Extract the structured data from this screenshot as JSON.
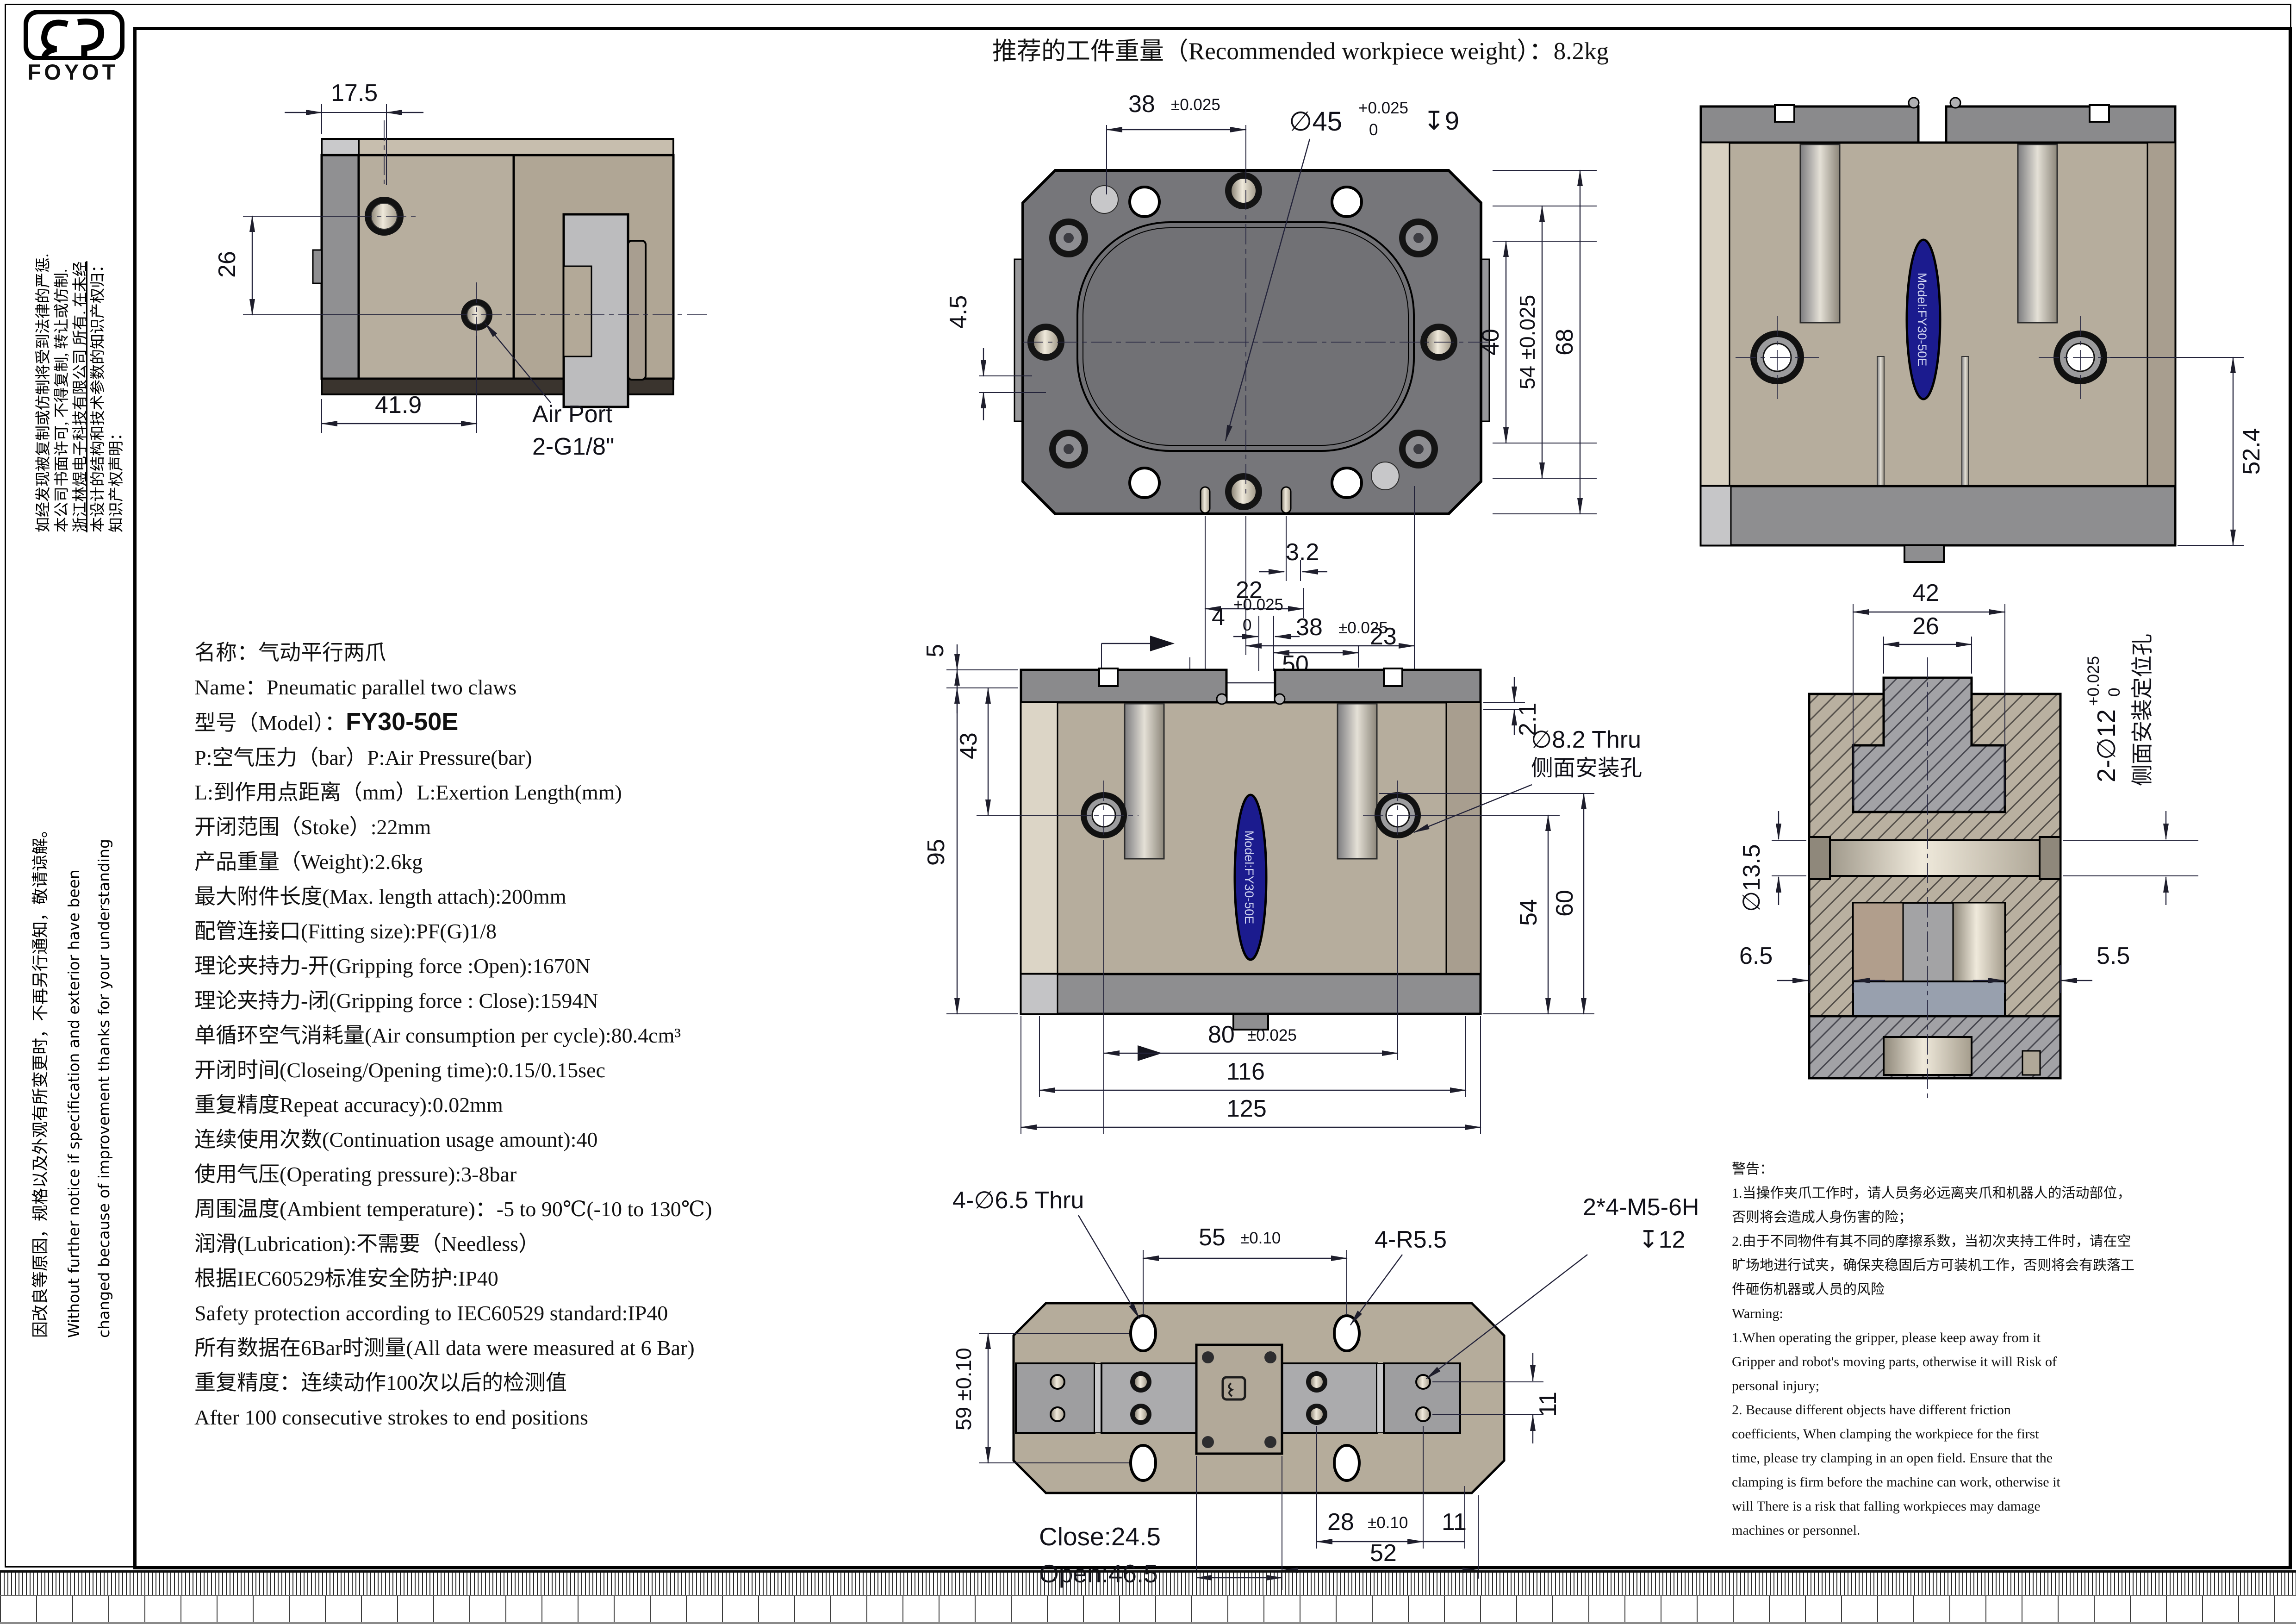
{
  "page": {
    "title": "推荐的工件重量（Recommended workpiece weight）：8.2kg"
  },
  "sidebar": {
    "brand": "FOYOT",
    "ip_lines": [
      "知识产权声明：",
      "本设计的结构和技术参数的知识产权归：",
      "浙江林煜电子科技有限公司 所有. 在未经",
      "本公司书面许可, 不得复制, 转让或仿制.",
      "如经发现被复制或仿制将受到法律的严惩."
    ],
    "change_lines": [
      "因改良等原因，规格以及外观有所变更时，不再另行通知，敬请谅解。",
      "Without further  notice if specification and exterior have been",
      "changed because of improvement thanks for your understanding"
    ]
  },
  "specs": {
    "lines_top": [
      "名称：气动平行两爪",
      "Name：Pneumatic parallel two claws"
    ],
    "model_label": "型号（Model）：",
    "model_value": "FY30-50E",
    "lines": [
      "P:空气压力（bar）P:Air Pressure(bar)",
      "L:到作用点距离（mm）L:Exertion Length(mm)",
      "开闭范围（Stoke）:22mm",
      "产品重量（Weight):2.6kg",
      "最大附件长度(Max. length attach):200mm",
      "配管连接口(Fitting size):PF(G)1/8",
      "理论夹持力-开(Gripping force :Open):1670N",
      "理论夹持力-闭(Gripping force : Close):1594N",
      "单循环空气消耗量(Air consumption per cycle):80.4cm³",
      "开闭时间(Closeing/Opening time):0.15/0.15sec",
      "重复精度Repeat accuracy):0.02mm",
      "连续使用次数(Continuation usage amount):40",
      "使用气压(Operating pressure):3-8bar",
      "周围温度(Ambient temperature)：-5 to 90℃(-10 to 130℃)",
      "润滑(Lubrication):不需要（Needless）",
      "根据IEC60529标准安全防护:IP40",
      "Safety protection according to IEC60529 standard:IP40",
      "所有数据在6Bar时测量(All data were measured at 6 Bar)",
      "重复精度：连续动作100次以后的检测值",
      "After 100 consecutive strokes to end positions"
    ]
  },
  "views": {
    "side": {
      "dim_top": "17.5",
      "dim_left": "26",
      "dim_bottom": "41.9",
      "air_port": "Air Port",
      "air_port2": "2-G1/8\""
    },
    "top": {
      "dim_38_top": "38",
      "tol_38_top": "±0.025",
      "bore": "∅45",
      "bore_tol_up": "+0.025",
      "bore_tol_dn": "0",
      "bore_depth": "↧9",
      "dim_40": "40",
      "dim_54": "54 ±0.025",
      "dim_68": "68",
      "dim_45_left": "4.5",
      "dim_32": "3.2",
      "dim_22": "22",
      "dim_38_bot": "38",
      "tol_38_bot": "±0.025",
      "dim_50": "50"
    },
    "front_right": {
      "dim_524": "52.4",
      "label": "Model:FY30-50E"
    },
    "front_center": {
      "dim_5": "5",
      "dim_43": "43",
      "dim_95": "95",
      "dim_4": "4",
      "tol_4_up": "+0.025",
      "tol_4_dn": "0",
      "dim_23": "23",
      "dim_21": "2.1",
      "hole_note1": "∅8.2 Thru",
      "hole_note2": "侧面安装孔",
      "dim_54": "54",
      "dim_60": "60",
      "dim_80": "80",
      "tol_80": "±0.025",
      "dim_116": "116",
      "dim_125": "125",
      "label": "Model:FY30-50E"
    },
    "section": {
      "dim_42": "42",
      "dim_26": "26",
      "pin_note": "2-∅12",
      "pin_tol_up": "+0.025",
      "pin_tol_dn": "0",
      "pin_note2": "侧面安装定位孔",
      "dim_135": "∅13.5",
      "dim_65": "6.5",
      "dim_55": "5.5"
    },
    "bottom": {
      "hole_note": "4-∅6.5 Thru",
      "dim_55": "55",
      "tol_55": "±0.10",
      "radius_note": "4-R5.5",
      "thread_note": "2*4-M5-6H",
      "thread_depth": "↧12",
      "dim_59": "59 ±0.10",
      "dim_11_right": "11",
      "dim_28": "28",
      "tol_28": "±0.10",
      "dim_11_bot": "11",
      "dim_52": "52",
      "close_label": "Close:24.5",
      "open_label": "Open:46.5"
    }
  },
  "warning": {
    "lines": [
      "警告：",
      "1.当操作夹爪工作时，请人员务必远离夹爪和机器人的活动部位，",
      "否则将会造成人身伤害的险；",
      "2.由于不同物件有其不同的摩擦系数，当初次夹持工件时，请在空",
      "旷场地进行试夹，确保夹稳固后方可装机工作，否则将会有跌落工",
      "件砸伤机器或人员的风险",
      "Warning:",
      "1.When operating the gripper, please keep away from it",
      "Gripper and robot's moving parts, otherwise it will Risk of",
      "personal injury;",
      "2. Because different objects have different friction",
      "coefficients, When clamping the workpiece for the first",
      "time, please try clamping in an open field. Ensure that the",
      "clamping is firm before the machine can work, otherwise it",
      "will There is a risk that falling workpieces may damage",
      "machines or personnel."
    ]
  }
}
